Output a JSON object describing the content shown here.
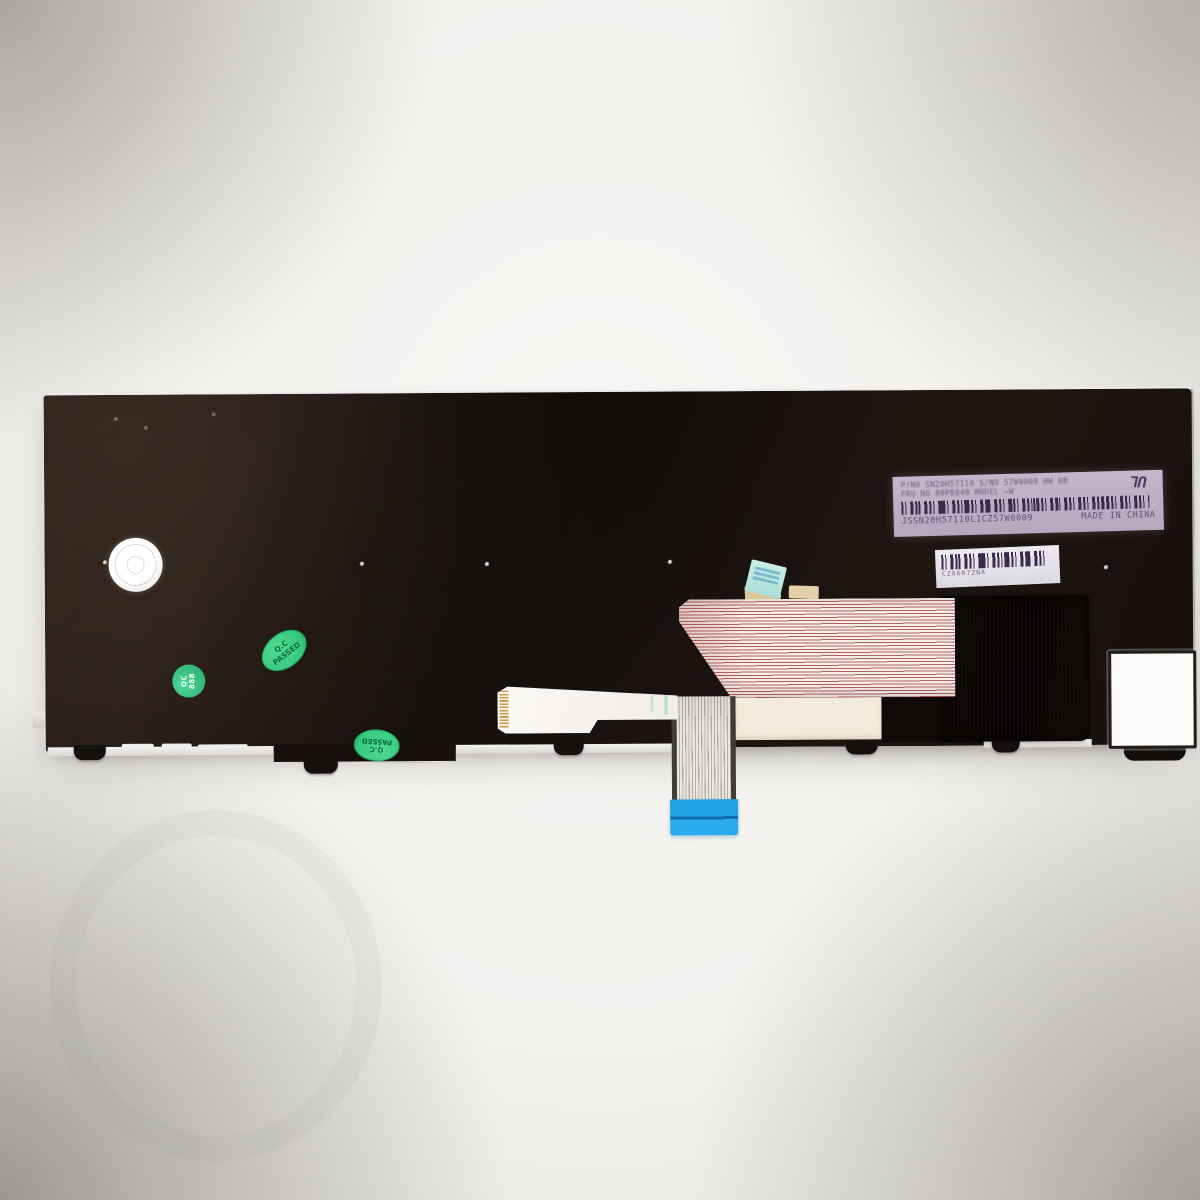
{
  "product_label": {
    "line1": "P/NO  SN20H57110   S/NO 57W0009   HW 0B",
    "line2": "FRU NO  00PB848    MODEL  —W",
    "serial": "JSSN20H57110L1CZ57W0009",
    "origin": "MADE IN CHINA",
    "cert_mark": "UL"
  },
  "barcode_sticker": {
    "code": "CZ6607ZNA"
  },
  "qc_oval": {
    "line1": "Q.C",
    "line2": "PASSED"
  },
  "qc_round": {
    "line1": "QC",
    "line2": "888"
  },
  "colors": {
    "plate_black": "#1c140f",
    "qc_green": "#35c97e",
    "ribbon_stripe_red": "#b85e5e",
    "connector_blue": "#21a2e7",
    "label_lavender": "#bcb0c5",
    "background_white": "#f3f2ef"
  }
}
